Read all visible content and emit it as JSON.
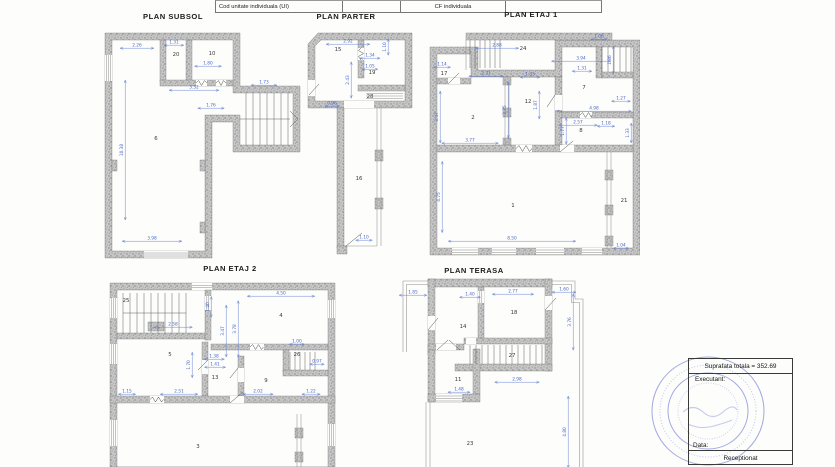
{
  "table": {
    "cells": [
      "Cod unitate individuala (UI)",
      "",
      "CF individuala",
      ""
    ]
  },
  "plans": {
    "subsol": {
      "title": "PLAN SUBSOL",
      "rooms": [
        {
          "n": "20",
          "x": 176,
          "y": 56
        },
        {
          "n": "10",
          "x": 212,
          "y": 55
        },
        {
          "n": "6",
          "x": 156,
          "y": 140
        }
      ],
      "dims": [
        {
          "v": "2.26",
          "x": 137,
          "y": 46,
          "o": "h"
        },
        {
          "v": "1.31",
          "x": 174,
          "y": 43,
          "o": "h"
        },
        {
          "v": "1.80",
          "x": 208,
          "y": 64,
          "o": "h"
        },
        {
          "v": "3.32",
          "x": 194,
          "y": 88,
          "o": "h"
        },
        {
          "v": "1.76",
          "x": 211,
          "y": 106,
          "o": "h"
        },
        {
          "v": "1.73",
          "x": 264,
          "y": 83,
          "o": "h"
        },
        {
          "v": "10.38",
          "x": 123,
          "y": 150,
          "o": "v"
        },
        {
          "v": "3.98",
          "x": 152,
          "y": 239,
          "o": "h"
        }
      ]
    },
    "parter": {
      "title": "PLAN PARTER",
      "rooms": [
        {
          "n": "15",
          "x": 338,
          "y": 51
        },
        {
          "n": "19",
          "x": 372,
          "y": 74
        },
        {
          "n": "28",
          "x": 370,
          "y": 98
        },
        {
          "n": "16",
          "x": 359,
          "y": 180
        }
      ],
      "dims": [
        {
          "v": "2.92",
          "x": 348,
          "y": 42,
          "o": "h"
        },
        {
          "v": "1.34",
          "x": 370,
          "y": 56,
          "o": "h"
        },
        {
          "v": "1.05",
          "x": 370,
          "y": 67,
          "o": "h"
        },
        {
          "v": "1.10",
          "x": 386,
          "y": 47,
          "o": "v"
        },
        {
          "v": "2.43",
          "x": 349,
          "y": 80,
          "o": "v"
        },
        {
          "v": "0.96",
          "x": 332,
          "y": 104,
          "o": "h"
        },
        {
          "v": "1.10",
          "x": 364,
          "y": 238,
          "o": "h"
        }
      ]
    },
    "etaj1": {
      "title": "PLAN ETAJ 1",
      "rooms": [
        {
          "n": "24",
          "x": 523,
          "y": 50
        },
        {
          "n": "17",
          "x": 444,
          "y": 75
        },
        {
          "n": "2",
          "x": 473,
          "y": 119
        },
        {
          "n": "12",
          "x": 528,
          "y": 103
        },
        {
          "n": "7",
          "x": 584,
          "y": 89
        },
        {
          "n": "8",
          "x": 581,
          "y": 132
        },
        {
          "n": "1",
          "x": 513,
          "y": 207
        },
        {
          "n": "21",
          "x": 624,
          "y": 202
        }
      ],
      "dims": [
        {
          "v": "2.88",
          "x": 497,
          "y": 46,
          "o": "h"
        },
        {
          "v": "3.94",
          "x": 581,
          "y": 59,
          "o": "h"
        },
        {
          "v": "1.06",
          "x": 599,
          "y": 37,
          "o": "h"
        },
        {
          "v": "1.14",
          "x": 442,
          "y": 65,
          "o": "h"
        },
        {
          "v": "2.31",
          "x": 486,
          "y": 74,
          "o": "h"
        },
        {
          "v": "1.33",
          "x": 530,
          "y": 75,
          "o": "h"
        },
        {
          "v": "1.31",
          "x": 582,
          "y": 69,
          "o": "h"
        },
        {
          "v": "3.75",
          "x": 506,
          "y": 110,
          "o": "v"
        },
        {
          "v": "1.87",
          "x": 537,
          "y": 105,
          "o": "v"
        },
        {
          "v": "4.98",
          "x": 594,
          "y": 109,
          "o": "h"
        },
        {
          "v": "2.57",
          "x": 578,
          "y": 123,
          "o": "h"
        },
        {
          "v": "1.18",
          "x": 606,
          "y": 124,
          "o": "h"
        },
        {
          "v": "1.77",
          "x": 564,
          "y": 131,
          "o": "v"
        },
        {
          "v": "1.33",
          "x": 629,
          "y": 133,
          "o": "v"
        },
        {
          "v": "3.47",
          "x": 438,
          "y": 117,
          "o": "v"
        },
        {
          "v": "3.77",
          "x": 470,
          "y": 141,
          "o": "h"
        },
        {
          "v": "4.75",
          "x": 440,
          "y": 197,
          "o": "v"
        },
        {
          "v": "8.50",
          "x": 512,
          "y": 239,
          "o": "h"
        },
        {
          "v": "1.04",
          "x": 621,
          "y": 246,
          "o": "h"
        },
        {
          "v": "1.27",
          "x": 621,
          "y": 99,
          "o": "h"
        },
        {
          "v": "1.86",
          "x": 611,
          "y": 60,
          "o": "v"
        }
      ]
    },
    "etaj2": {
      "title": "PLAN ETAJ 2",
      "rooms": [
        {
          "n": "25",
          "x": 126,
          "y": 302
        },
        {
          "n": "4",
          "x": 281,
          "y": 317
        },
        {
          "n": "5",
          "x": 170,
          "y": 356
        },
        {
          "n": "13",
          "x": 215,
          "y": 379
        },
        {
          "n": "9",
          "x": 266,
          "y": 382
        },
        {
          "n": "26",
          "x": 297,
          "y": 356
        },
        {
          "n": "3",
          "x": 198,
          "y": 448
        }
      ],
      "dims": [
        {
          "v": "4.50",
          "x": 281,
          "y": 294,
          "o": "h"
        },
        {
          "v": "2.58",
          "x": 173,
          "y": 325,
          "o": "h"
        },
        {
          "v": "1.40",
          "x": 209,
          "y": 307,
          "o": "v"
        },
        {
          "v": "3.47",
          "x": 224,
          "y": 331,
          "o": "v"
        },
        {
          "v": "3.78",
          "x": 236,
          "y": 329,
          "o": "v"
        },
        {
          "v": "1.00",
          "x": 297,
          "y": 342,
          "o": "h"
        },
        {
          "v": "0.97",
          "x": 317,
          "y": 362,
          "o": "h"
        },
        {
          "v": "1.38",
          "x": 214,
          "y": 357,
          "o": "h"
        },
        {
          "v": "1.41",
          "x": 215,
          "y": 365,
          "o": "h"
        },
        {
          "v": "1.70",
          "x": 190,
          "y": 365,
          "o": "v"
        },
        {
          "v": "1.15",
          "x": 127,
          "y": 392,
          "o": "h"
        },
        {
          "v": "2.51",
          "x": 179,
          "y": 392,
          "o": "h"
        },
        {
          "v": "2.02",
          "x": 258,
          "y": 392,
          "o": "h"
        },
        {
          "v": "1.22",
          "x": 311,
          "y": 392,
          "o": "h"
        }
      ]
    },
    "terasa": {
      "title": "PLAN TERASA",
      "rooms": [
        {
          "n": "14",
          "x": 463,
          "y": 328
        },
        {
          "n": "18",
          "x": 514,
          "y": 314
        },
        {
          "n": "27",
          "x": 512,
          "y": 357
        },
        {
          "n": "11",
          "x": 458,
          "y": 381
        },
        {
          "n": "23",
          "x": 470,
          "y": 445
        }
      ],
      "dims": [
        {
          "v": "1.85",
          "x": 413,
          "y": 293,
          "o": "h"
        },
        {
          "v": "1.40",
          "x": 470,
          "y": 295,
          "o": "h"
        },
        {
          "v": "2.77",
          "x": 513,
          "y": 292,
          "o": "h"
        },
        {
          "v": "1.60",
          "x": 564,
          "y": 290,
          "o": "h"
        },
        {
          "v": "3.76",
          "x": 571,
          "y": 322,
          "o": "v"
        },
        {
          "v": "2.98",
          "x": 517,
          "y": 380,
          "o": "h"
        },
        {
          "v": "1.48",
          "x": 459,
          "y": 390,
          "o": "h"
        },
        {
          "v": "4.80",
          "x": 566,
          "y": 432,
          "o": "v"
        }
      ]
    }
  },
  "info_box": {
    "suprafata": "Suprafata totala = 352.69",
    "executant": "Executant:",
    "data": "Data:",
    "receptionat": "Receptionat"
  },
  "colors": {
    "dimension_blue": "#4a67c8",
    "wall_gray": "#c6c6c6",
    "stamp_blue": "#4758c8"
  }
}
